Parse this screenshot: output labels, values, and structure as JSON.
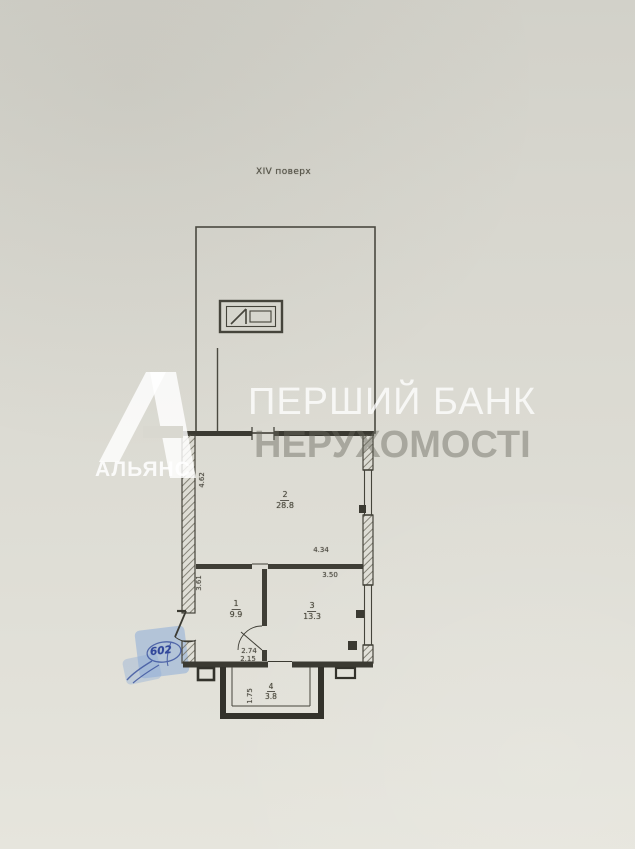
{
  "title": {
    "floor_label": "XIV поверх"
  },
  "watermark": {
    "brand_line1": "ПЕРШИЙ БАНК",
    "brand_line2": "НЕРУХОМОСТІ",
    "logo_text": "АЛЬЯНС"
  },
  "annotations": {
    "apartment_number_handwritten": "602"
  },
  "rooms": [
    {
      "number": "2",
      "area": "28.8"
    },
    {
      "number": "1",
      "area": "9.9"
    },
    {
      "number": "3",
      "area": "13.3"
    },
    {
      "number": "4",
      "area": "3.8"
    }
  ],
  "dimensions": {
    "room2_left_height": "4.62",
    "room2_bottom_width": "4.34",
    "room3_top_width": "3.50",
    "room1_left_height": "3.61",
    "room1_bottom_width": "2.74",
    "balcony_top_width": "2.15",
    "balcony_side_depth": "1.75"
  },
  "colors": {
    "paper": "#dcdbd3",
    "plan_line": "#45443b",
    "wall_fill": "#3b3a32",
    "watermark_white": "#ffffff",
    "watermark_gray": "#68685e",
    "pen_ink_blue": "#31479b",
    "marker_highlight_blue": "#8eadd8"
  }
}
